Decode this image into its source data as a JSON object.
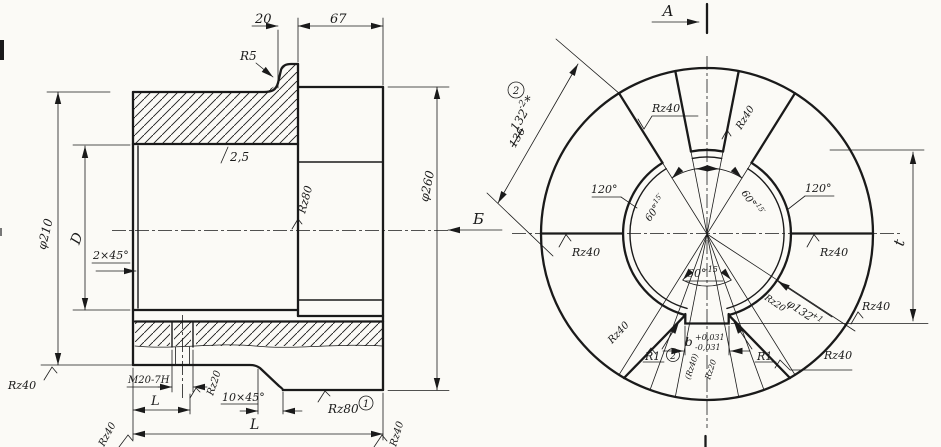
{
  "colors": {
    "ink": "#1a1a1a",
    "paper": "#fbfaf6"
  },
  "section_view": {
    "dim_20": "20",
    "dim_67": "67",
    "radius_r5": "R5",
    "finish_2_5": "2,5",
    "rz80_bore": "Rz80",
    "dia_260": "φ260",
    "dia_210": "φ210",
    "dim_d": "D",
    "chamfer_2x45": "2×45°",
    "rz40_left": "Rz40",
    "thread_m20": "M20-7H",
    "rz20_thread": "Rz20",
    "dim_l_small": "L",
    "chamfer_10x45": "10×45°",
    "rz80_face": "Rz80",
    "ref_1": "1",
    "dim_l_total": "L",
    "rz40_corner_left": "Rz40",
    "rz40_corner_right": "Rz40"
  },
  "front_view": {
    "view_a": "A",
    "view_b": "Б",
    "ref_2": "2",
    "dim_132": "132",
    "dim_132_tol": "-2",
    "dim_132_star": "*",
    "dim_136_struck": "136",
    "angle_120_left": "120°",
    "angle_120_right": "120°",
    "angle_60_left": "60°",
    "angle_60_left_tol": "-15′",
    "angle_60_right": "60°",
    "angle_60_right_tol": "-15′",
    "angle_60_bottom": "60°",
    "angle_60_bottom_tol": "-15",
    "rz40_slot_tl": "Rz40",
    "rz40_slot_tr": "Rz40",
    "rz40_left": "Rz40",
    "rz40_right": "Rz40",
    "rz20_bore": "Rz20",
    "dia_132": "φ132",
    "dia_132_tol": "+1",
    "rz40_keyway_ext": "Rz40",
    "rz40_slot_bl": "Rz40",
    "rz40_slot_br": "Rz40",
    "r1_left": "R1",
    "r1_right": "R1",
    "ref_2_keyway": "2",
    "key_width": "b",
    "key_tol_plus": "+0,031",
    "key_tol_minus": "-0,031",
    "rz40_keyway_side": "(Rz40)",
    "rz20_keyway": "Rz20",
    "dim_t": "t"
  }
}
